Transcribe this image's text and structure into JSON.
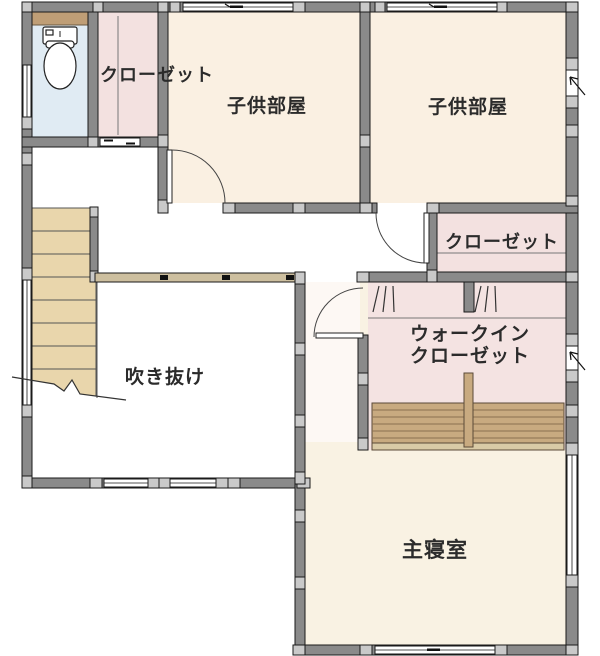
{
  "labels": {
    "closet_top": "クローゼット",
    "kids_room_1": "子供部屋",
    "kids_room_2": "子供部屋",
    "closet_right": "クローゼット",
    "walk_in_closet_line1": "ウォークイン",
    "walk_in_closet_line2": "クローゼット",
    "atrium": "吹き抜け",
    "master_bedroom": "主寝室"
  },
  "icons": {
    "toilet": "toilet-icon",
    "stairs": "stairs",
    "vent": "vent-arrow-icon",
    "door_swing": "door-swing-arc",
    "hanger_marks": "hanger-pipe-marks"
  },
  "colors": {
    "wall_fill": "#8a8a8a",
    "post_fill": "#c9c9c9",
    "wall_outline": "#1a1a1a",
    "stairs_fill": "#e9d6ac",
    "shelf_fill": "#c8aa80",
    "shelf_rim": "#d9caa6",
    "railing_fill": "#cdbf9f",
    "toilet_room_floor": "#e0ebf3",
    "toilet_shelf": "#bf9e76",
    "closet_floor": "#f3e1e0",
    "kids_room_floor": "#faf0e2",
    "master_bedroom_floor": "#f9f2e3",
    "walk_in_closet_floor": "#f4e3e2",
    "hall_floor": "#ffffff",
    "label_text": "#2b2b2b"
  }
}
